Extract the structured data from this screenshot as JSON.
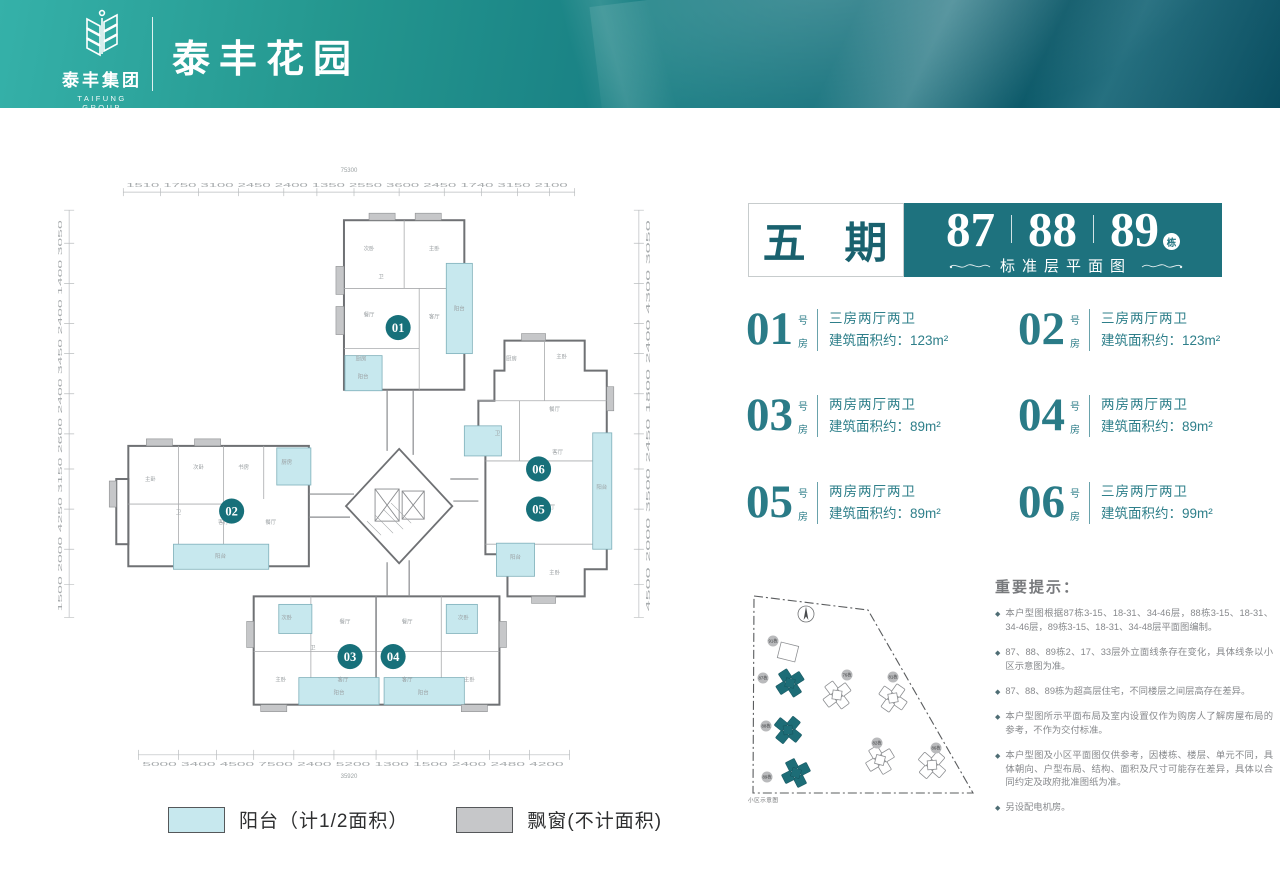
{
  "palette": {
    "header_teal_light": "#35b1a9",
    "header_teal_dark": "#0b5a6e",
    "brand_teal": "#1e727e",
    "unit_teal": "#2a7b87",
    "badge_teal": "#17707a",
    "balcony_fill": "#c7e8ee",
    "bay_window_fill": "#c6c7c9"
  },
  "header": {
    "brand_cn": "泰丰集团",
    "brand_en": "TAIFUNG GROUP",
    "project": "泰丰花园"
  },
  "title_block": {
    "phase": "五 期",
    "building_1": "87",
    "building_2": "88",
    "building_3": "89",
    "building_suffix": "栋",
    "subtitle": "标准层平面图"
  },
  "units": [
    {
      "number": "01",
      "tag_top": "号",
      "tag_bottom": "房",
      "layout": "三房两厅两卫",
      "area": "建筑面积约：123m²"
    },
    {
      "number": "02",
      "tag_top": "号",
      "tag_bottom": "房",
      "layout": "三房两厅两卫",
      "area": "建筑面积约：123m²"
    },
    {
      "number": "03",
      "tag_top": "号",
      "tag_bottom": "房",
      "layout": "两房两厅两卫",
      "area": "建筑面积约：89m²"
    },
    {
      "number": "04",
      "tag_top": "号",
      "tag_bottom": "房",
      "layout": "两房两厅两卫",
      "area": "建筑面积约：89m²"
    },
    {
      "number": "05",
      "tag_top": "号",
      "tag_bottom": "房",
      "layout": "两房两厅两卫",
      "area": "建筑面积约：89m²"
    },
    {
      "number": "06",
      "tag_top": "号",
      "tag_bottom": "房",
      "layout": "三房两厅两卫",
      "area": "建筑面积约：99m²"
    }
  ],
  "notes": {
    "title": "重要提示：",
    "items": [
      "本户型图根据87栋3-15、18-31、34-46层，88栋3-15、18-31、34-46层，89栋3-15、18-31、34-48层平面图编制。",
      "87、88、89栋2、17、33层外立面线条存在变化，具体线条以小区示意图为准。",
      "87、88、89栋为超高层住宅，不同楼层之间层高存在差异。",
      "本户型图所示平面布局及室内设置仅作为购房人了解房屋布局的参考，不作为交付标准。",
      "本户型图及小区平面图仅供参考，因楼栋、楼层、单元不同，具体朝向、户型布局、结构、面积及尺寸可能存在差异，具体以合同约定及政府批准图纸为准。",
      "另设配电机房。"
    ]
  },
  "siteplan": {
    "caption": "小区示意图",
    "badges": [
      {
        "label": "91栋",
        "x": 33,
        "y": 61,
        "highlight": false
      },
      {
        "label": "87栋",
        "x": 23,
        "y": 98,
        "highlight": true
      },
      {
        "label": "88栋",
        "x": 26,
        "y": 146,
        "highlight": true
      },
      {
        "label": "89栋",
        "x": 27,
        "y": 197,
        "highlight": true
      },
      {
        "label": "76栋",
        "x": 107,
        "y": 95,
        "highlight": false
      },
      {
        "label": "81栋",
        "x": 153,
        "y": 97,
        "highlight": false
      },
      {
        "label": "82栋",
        "x": 137,
        "y": 163,
        "highlight": false
      },
      {
        "label": "86栋",
        "x": 196,
        "y": 168,
        "highlight": false
      }
    ]
  },
  "legend": [
    {
      "label": "阳台（计1/2面积）",
      "color": "#c7e8ee"
    },
    {
      "label": "飘窗(不计面积)",
      "color": "#c6c7c9"
    }
  ],
  "floorplan": {
    "units": [
      {
        "number": "01"
      },
      {
        "number": "02"
      },
      {
        "number": "03"
      },
      {
        "number": "04"
      },
      {
        "number": "05"
      },
      {
        "number": "06"
      }
    ],
    "dims": {
      "top": "1510 1750 3100 2450 2400 1350 2550 3600 2450 1740 3150 2100",
      "top_total": "75300",
      "bottom": "5000 3400 4500 7500 2400 5200 1300 1500 2400 2480 4200",
      "bottom_total": "35920",
      "left": "1500 2000 4250 3150 2600 2400 3450 2400 1400 3050",
      "right": "4500 2000 3500 2450 1800 2400 4300 3050"
    },
    "room_labels": [
      {
        "t": "次卧",
        "x": 320,
        "y": 102
      },
      {
        "t": "主卧",
        "x": 385,
        "y": 102
      },
      {
        "t": "卫",
        "x": 332,
        "y": 130
      },
      {
        "t": "餐厅",
        "x": 320,
        "y": 168
      },
      {
        "t": "客厅",
        "x": 385,
        "y": 170
      },
      {
        "t": "厨房",
        "x": 312,
        "y": 212
      },
      {
        "t": "阳台",
        "x": 410,
        "y": 162
      },
      {
        "t": "阳台",
        "x": 314,
        "y": 230
      },
      {
        "t": "主卧",
        "x": 102,
        "y": 332
      },
      {
        "t": "次卧",
        "x": 150,
        "y": 320
      },
      {
        "t": "书房",
        "x": 195,
        "y": 320
      },
      {
        "t": "厨房",
        "x": 238,
        "y": 315
      },
      {
        "t": "卫",
        "x": 130,
        "y": 365
      },
      {
        "t": "客厅",
        "x": 175,
        "y": 375
      },
      {
        "t": "餐厅",
        "x": 222,
        "y": 375
      },
      {
        "t": "阳台",
        "x": 172,
        "y": 409
      },
      {
        "t": "次卧",
        "x": 238,
        "y": 470
      },
      {
        "t": "餐厅",
        "x": 296,
        "y": 474
      },
      {
        "t": "卫",
        "x": 264,
        "y": 500
      },
      {
        "t": "主卧",
        "x": 232,
        "y": 532
      },
      {
        "t": "客厅",
        "x": 294,
        "y": 532
      },
      {
        "t": "阳台",
        "x": 290,
        "y": 545
      },
      {
        "t": "餐厅",
        "x": 358,
        "y": 474
      },
      {
        "t": "次卧",
        "x": 414,
        "y": 470
      },
      {
        "t": "客厅",
        "x": 358,
        "y": 532
      },
      {
        "t": "主卧",
        "x": 420,
        "y": 532
      },
      {
        "t": "阳台",
        "x": 374,
        "y": 545
      },
      {
        "t": "主卧",
        "x": 512,
        "y": 210
      },
      {
        "t": "厨房",
        "x": 462,
        "y": 212
      },
      {
        "t": "餐厅",
        "x": 505,
        "y": 262
      },
      {
        "t": "卫",
        "x": 448,
        "y": 286
      },
      {
        "t": "客厅",
        "x": 508,
        "y": 305
      },
      {
        "t": "阳台",
        "x": 552,
        "y": 340
      },
      {
        "t": "客厅",
        "x": 500,
        "y": 360
      },
      {
        "t": "主卧",
        "x": 505,
        "y": 425
      },
      {
        "t": "阳台",
        "x": 466,
        "y": 410
      }
    ]
  }
}
